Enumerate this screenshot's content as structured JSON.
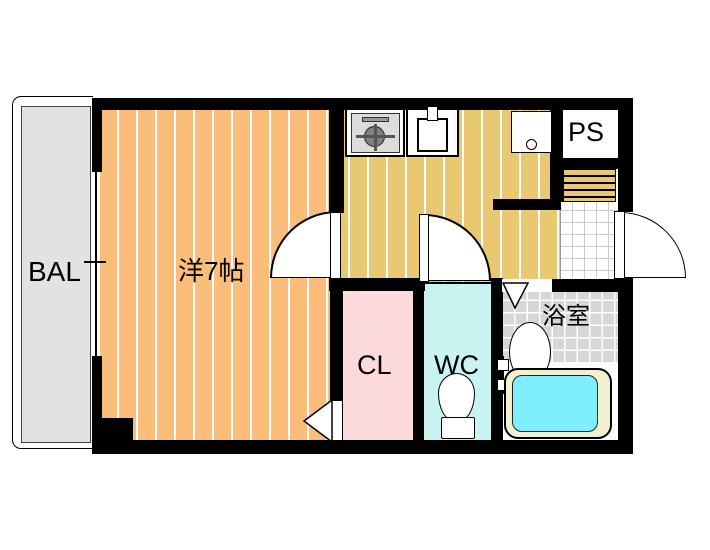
{
  "floorplan": {
    "labels": {
      "balcony": "BAL",
      "main_room": "洋7帖",
      "closet": "CL",
      "toilet": "WC",
      "bathroom": "浴室",
      "pipe_space": "PS"
    },
    "colors": {
      "wall": "#000000",
      "main_room_floor": "#FABE7A",
      "kitchen_floor": "#E8C870",
      "closet_floor": "#FCDADC",
      "toilet_floor": "#C9F3F1",
      "bathroom_tile": "#D6D6D6",
      "bathtub_water": "#7FEFFF",
      "bathtub_rim": "#F3F0D2",
      "balcony_floor": "#E2E2E2",
      "entrance_tile": "#FFFFFF"
    }
  }
}
